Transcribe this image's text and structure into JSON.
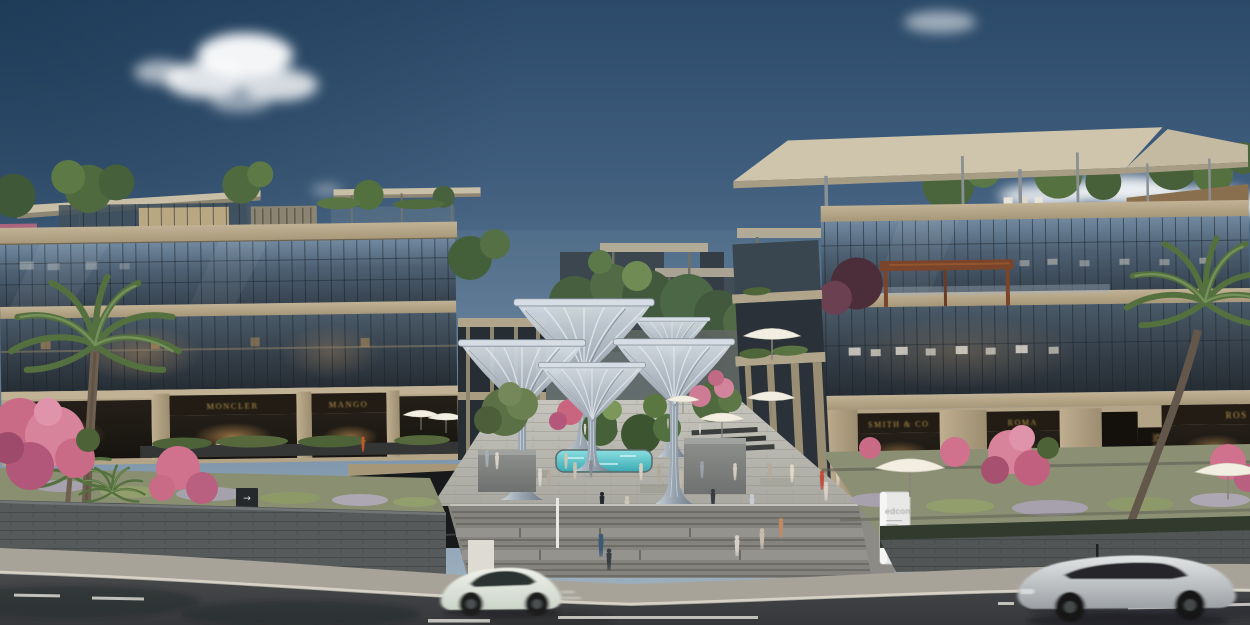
{
  "signs": {
    "monolith_brand": "edcon",
    "wayfinding_arrow": "→",
    "store_left_1": "MONCLER",
    "store_left_2": "MANGO",
    "store_right_1": "SMITH & CO",
    "store_right_2": "ROMA",
    "store_right_3": "ROS",
    "store_right_vertical": "MOREKA"
  },
  "palette": {
    "sky_top": "#2b4968",
    "sky_horizon": "#a3b4c2",
    "facade_beige": "#b3a488",
    "glass_blue": "#46586a",
    "sign_gold": "#c8a355",
    "flower_pink": "#d0718d",
    "pool_turquoise": "#52c2c8",
    "steel_grey": "#aab6c2",
    "road_asphalt": "#3e4042",
    "paving_grey": "#b4b3ab"
  }
}
